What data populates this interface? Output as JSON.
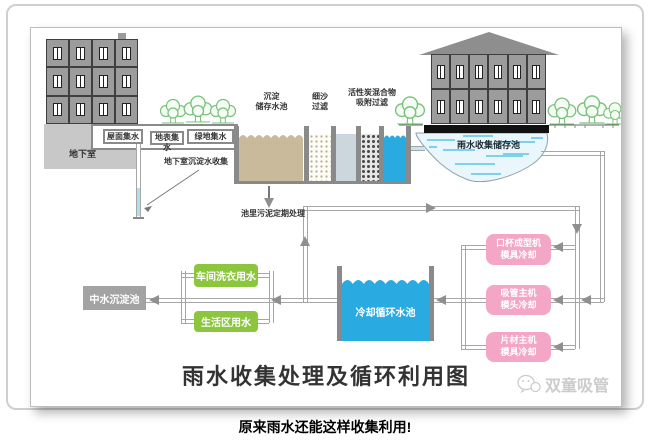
{
  "page": {
    "caption": "原来雨水还能这样收集利用!"
  },
  "diagram": {
    "title": "雨水收集处理及循环利用图",
    "watermark": "双童吸管",
    "collection": {
      "roof": "屋面集水",
      "surface": "地表集水",
      "green": "绿地集水",
      "basement": "地下室",
      "basement_drain": "地下室沉淀水收集"
    },
    "treatment": {
      "sediment_tank": "沉淀\n储存水池",
      "sand_filter": "细沙\n过滤",
      "carbon_filter": "活性炭混合物\n吸附过滤",
      "sludge_note": "池里污泥定期处理"
    },
    "storage_pond": "雨水收集储存池",
    "cooling": {
      "pool": "冷却循环水池",
      "machines": [
        "口杯成型机\n模具冷却",
        "吸管主机\n模头冷却",
        "片材主机\n模具冷却"
      ]
    },
    "reuse": {
      "reclaim_pool": "中水沉淀池",
      "uses": [
        "车间洗衣用水",
        "生活区用水"
      ]
    },
    "colors": {
      "machine_pink": "#f3a6c5",
      "use_green": "#8cc63f",
      "water_blue": "#29abe2",
      "sediment_tan": "#c9ba9c",
      "reclaim_gray": "#a3a3a3"
    }
  }
}
